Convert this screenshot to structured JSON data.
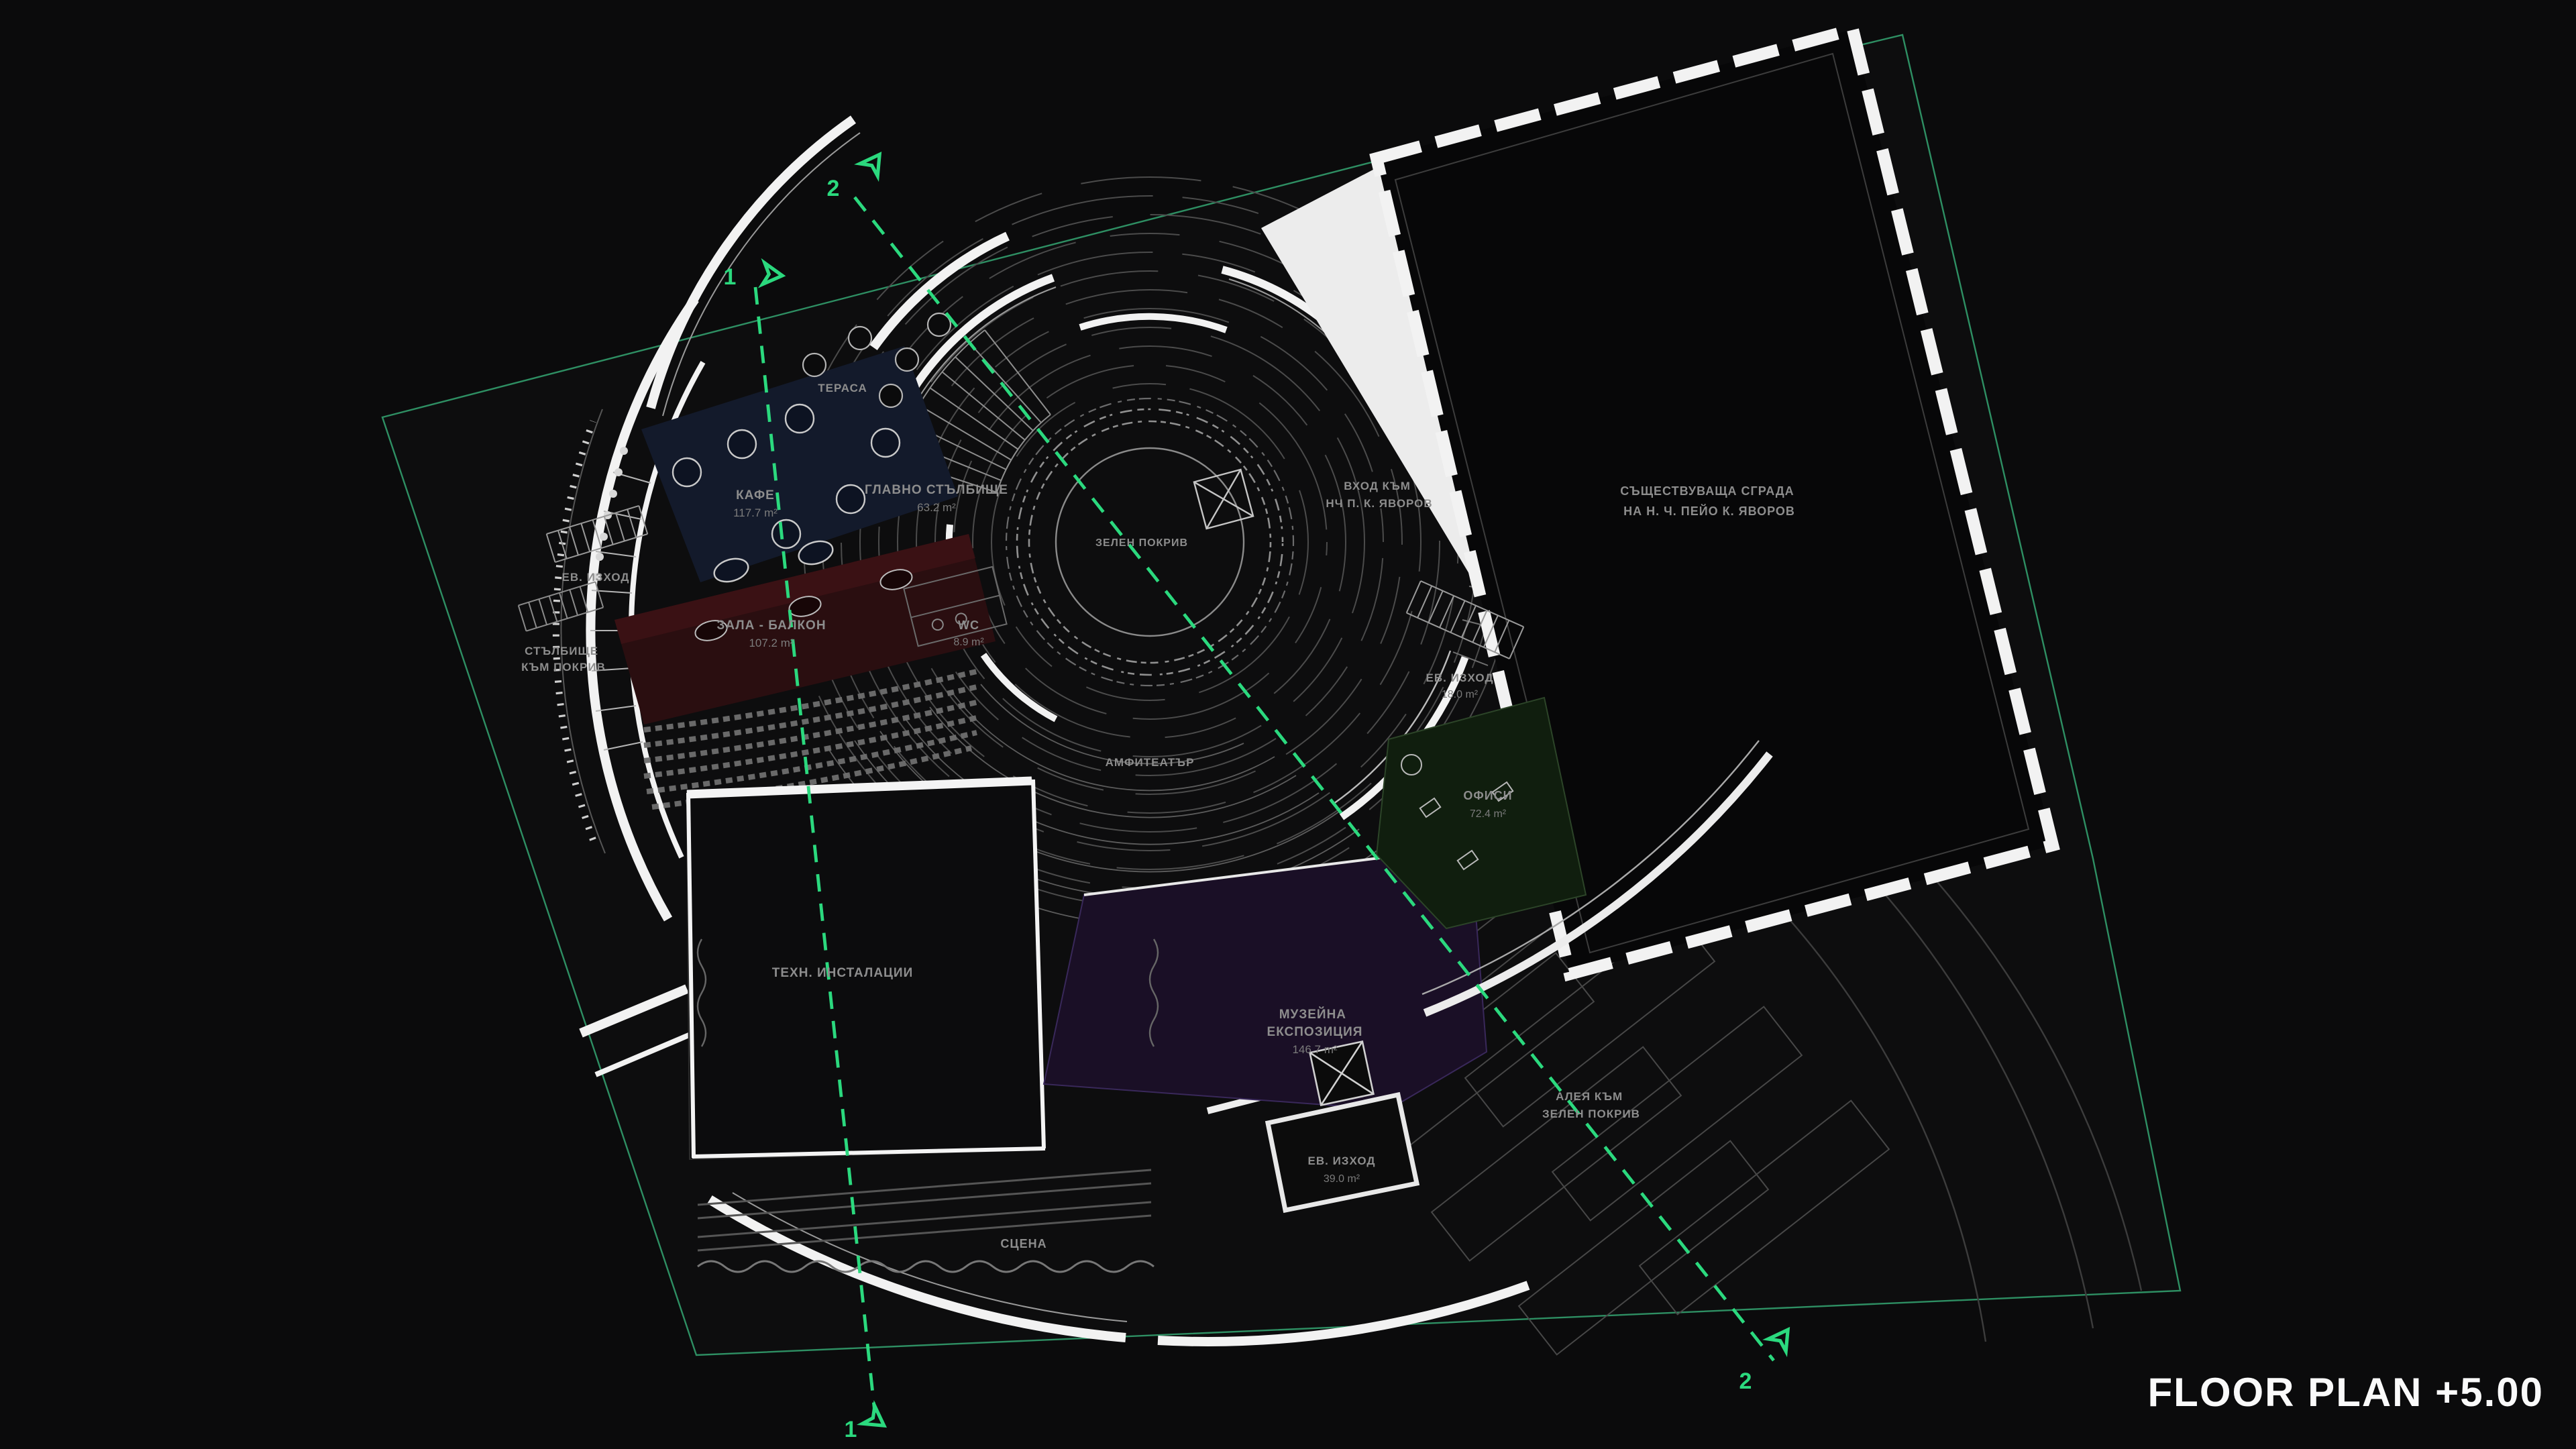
{
  "title": "FLOOR PLAN +5.00",
  "colors": {
    "bg": "#0b0b0c",
    "accent": "#2bd97e",
    "boundary": "#2e8f63",
    "cafe": "#131a2b",
    "hall": "#2a0e10",
    "museum": "#1a0f26",
    "offices": "#101e0e",
    "wall": "#f2f2f2",
    "label": "#8d8d8d"
  },
  "rooms": {
    "cafe": {
      "name": "КАФЕ",
      "area": "117.7 m²"
    },
    "terrace": {
      "name": "ТЕРАСА"
    },
    "main_stair": {
      "name": "ГЛАВНО СТЪЛБИЩЕ",
      "area": "63.2 m²"
    },
    "hall_balcony": {
      "name": "ЗАЛА - БАЛКОН",
      "area": "107.2 m²"
    },
    "wc": {
      "name": "WC",
      "area": "8.9 m²"
    },
    "exit_west": {
      "name": "ЕВ. ИЗХОД"
    },
    "roof_stair": {
      "line1": "СТЪЛБИЩЕ",
      "line2": "КЪМ ПОКРИВ"
    },
    "green_roof": {
      "name": "ЗЕЛЕН ПОКРИВ"
    },
    "entrance": {
      "line1": "ВХОД КЪМ",
      "line2": "НЧ П. К. ЯВОРОВ"
    },
    "existing_building": {
      "line1": "СЪЩЕСТВУВАЩА СГРАДА",
      "line2": "НА Н. Ч. ПЕЙО К. ЯВОРОВ"
    },
    "exit_northeast": {
      "name": "ЕВ. ИЗХОД",
      "area": "18.0 m²"
    },
    "amphitheater": {
      "name": "АМФИТЕАТЪР"
    },
    "offices": {
      "name": "ОФИСИ",
      "area": "72.4 m²"
    },
    "tech": {
      "name": "ТЕХН. ИНСТАЛАЦИИ"
    },
    "museum": {
      "line1": "МУЗЕЙНА",
      "line2": "ЕКСПОЗИЦИЯ",
      "area": "146.7 m²"
    },
    "alley": {
      "line1": "АЛЕЯ КЪМ",
      "line2": "ЗЕЛЕН ПОКРИВ"
    },
    "exit_south": {
      "name": "ЕВ. ИЗХОД",
      "area": "39.0 m²"
    },
    "stage": {
      "name": "СЦЕНА"
    }
  },
  "sections": {
    "s1": "1",
    "s2": "2"
  }
}
